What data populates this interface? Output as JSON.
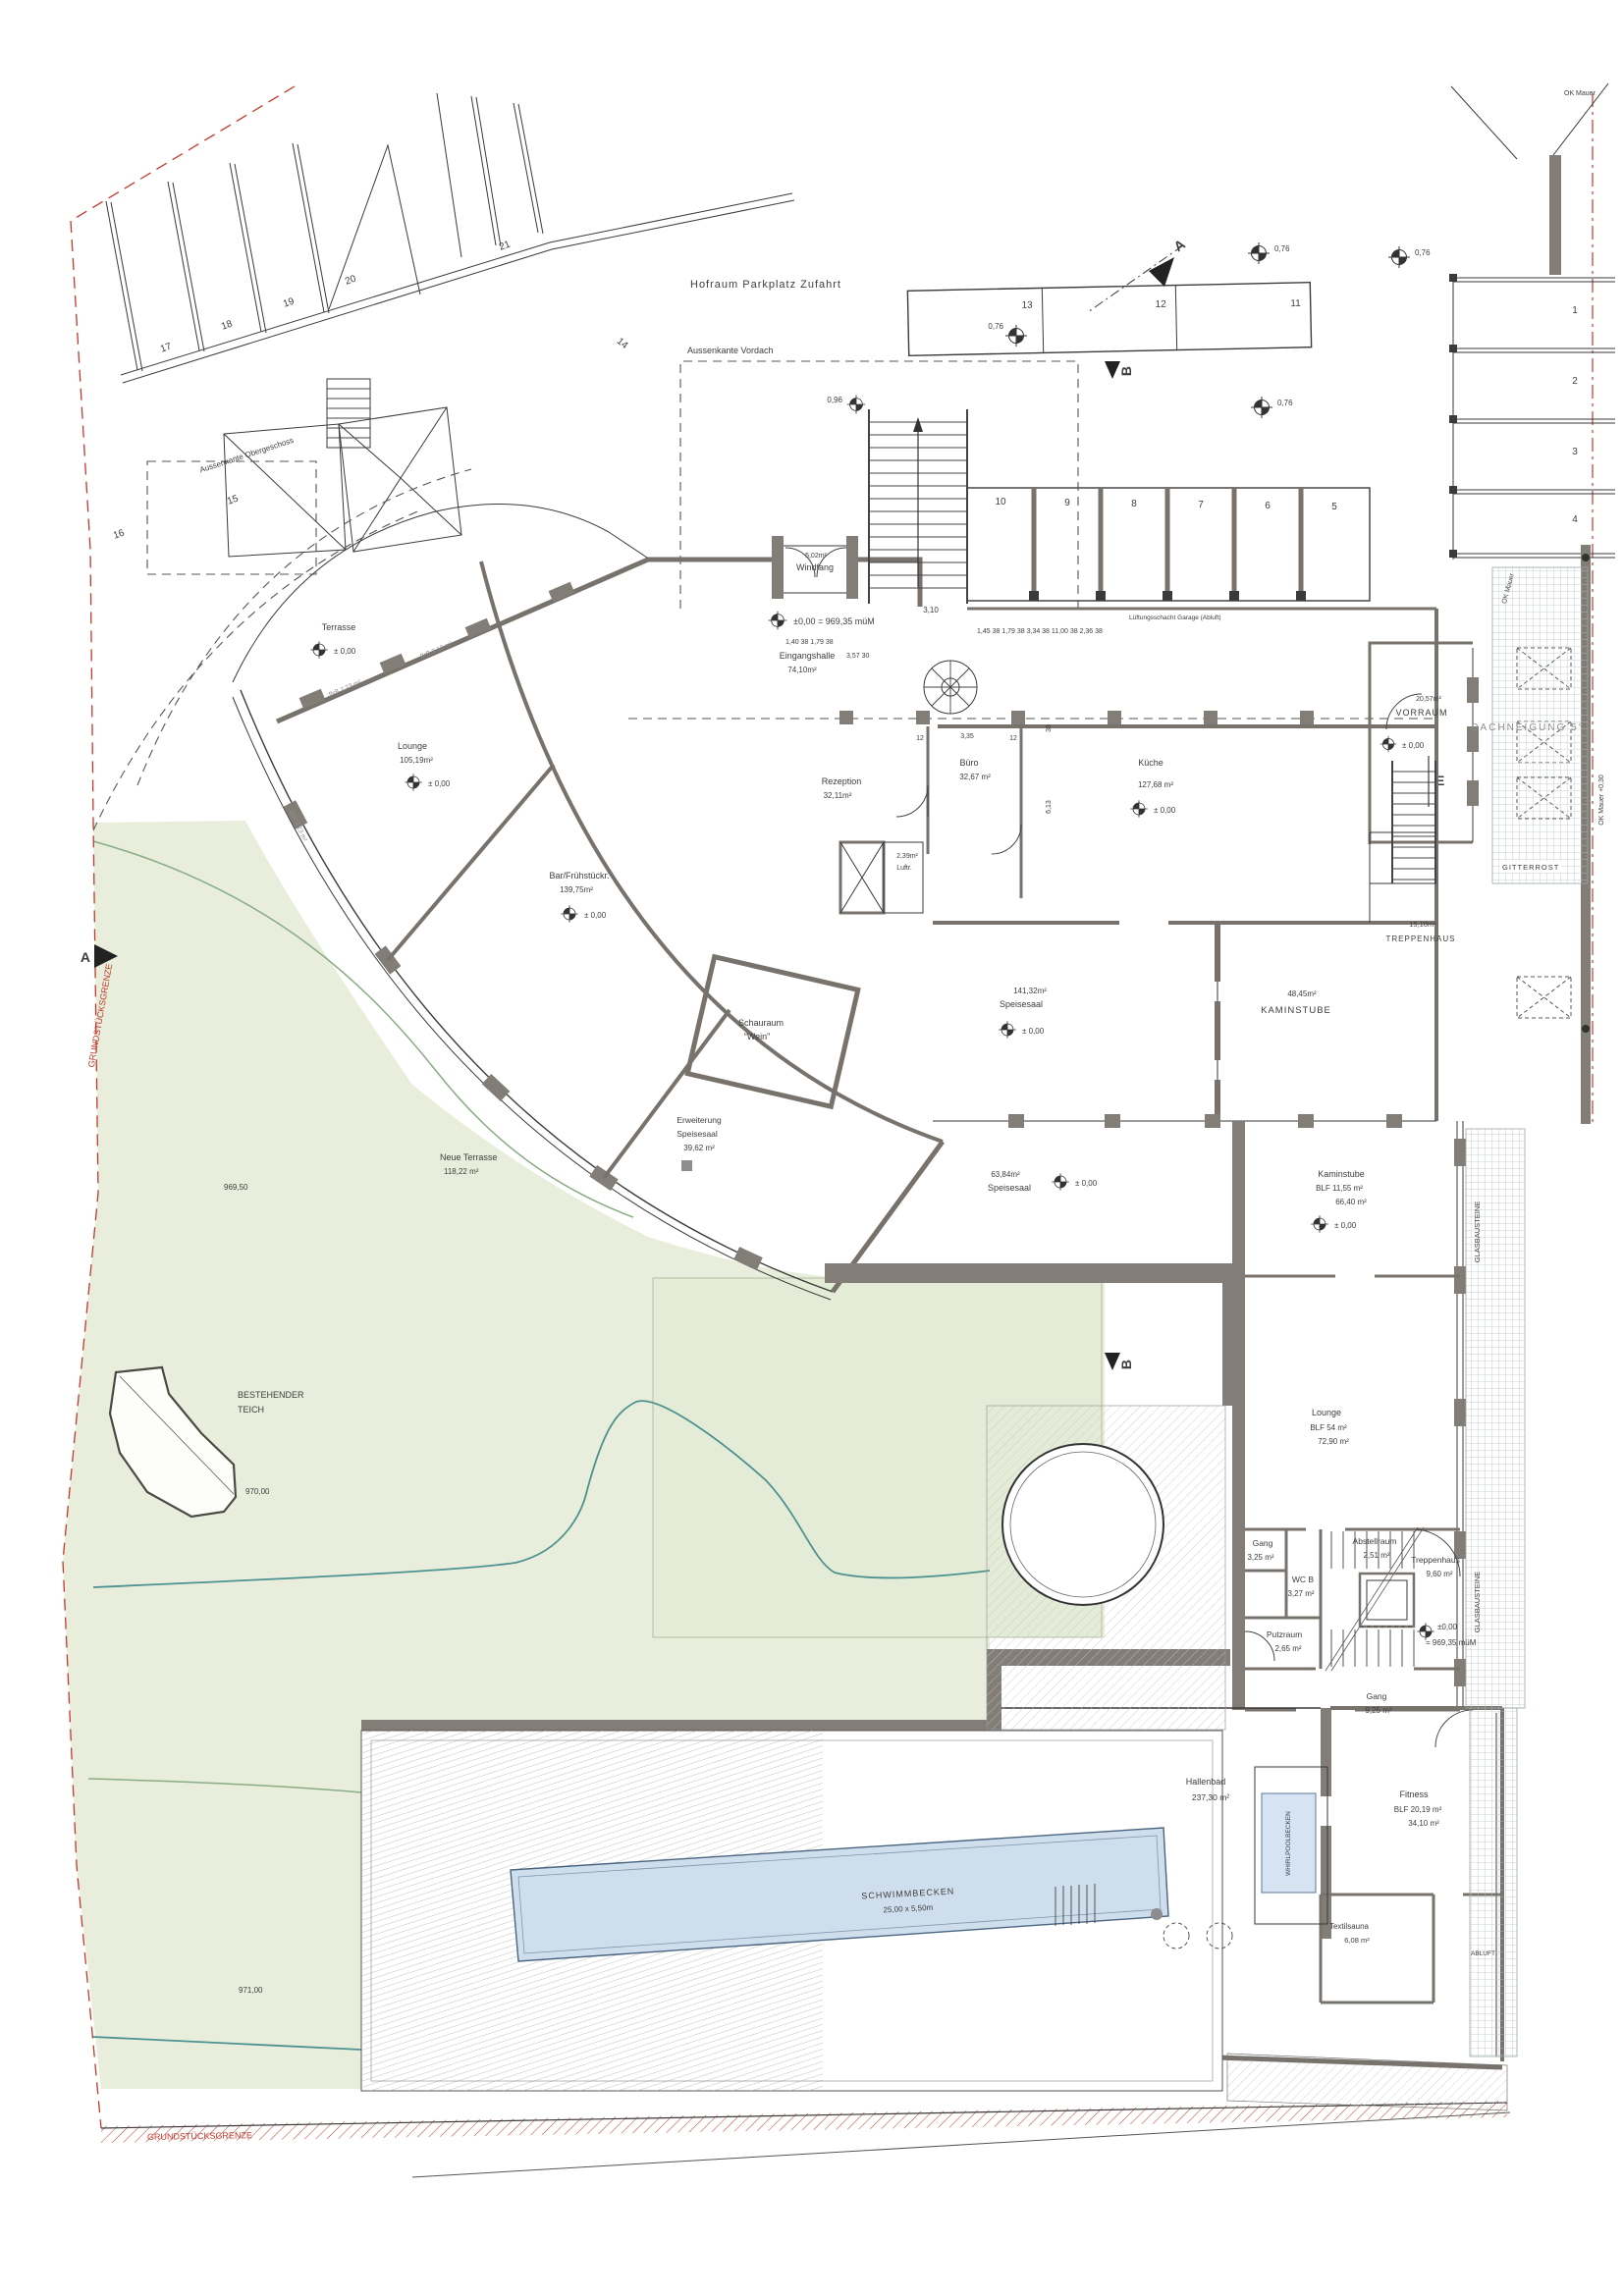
{
  "site": {
    "hofraum": "Hofraum  Parkplatz  Zufahrt",
    "aussenkante_vordach": "Aussenkante Vordach",
    "aussenkante_og": "Aussenkante Obergeschoss",
    "grenze_left": "GRUNDSTÜCKSGRENZE",
    "grenze_bottom": "GRUNDSTÜCKSGRENZE",
    "pond_1": "BESTEHENDER",
    "pond_2": "TEICH",
    "neue_terrasse_1": "Neue Terrasse",
    "neue_terrasse_2": "118,22 m²",
    "c96950": "969,50",
    "c97000": "970,00",
    "c97100": "971,00",
    "ok_mauer_top": "OK Mauer",
    "ok_mauer_mid": "OK Mauer",
    "ok_mauer_low": "OK Mauer +0,30",
    "gitterrost": "GITTERROST",
    "glasbausteine": "GLASBAUSTEINE"
  },
  "markers": {
    "section_a": "A",
    "section_b": "B",
    "detail_e": "E",
    "datum_entrance": "±0,00 = 969,35 müM",
    "datum_stair_1": "±0,00",
    "datum_stair_2": "= 969,35 müM",
    "level_zero": "± 0,00",
    "survey_076": "0,76",
    "survey_096": "0,96",
    "dim_310": "3,10"
  },
  "parking": {
    "numbers": [
      "17",
      "18",
      "19",
      "20",
      "21",
      "14",
      "15",
      "16",
      "13",
      "12",
      "11",
      "10",
      "9",
      "8",
      "7",
      "6",
      "5",
      "1",
      "2",
      "3",
      "4"
    ]
  },
  "rooms": {
    "terrasse": {
      "name": "Terrasse"
    },
    "lounge_w": {
      "name": "Lounge",
      "area": "105,19m²"
    },
    "bar": {
      "name": "Bar/Frühstückr.",
      "area": "139,75m²"
    },
    "windfang": {
      "area": "5,02m²",
      "name": "Windfang"
    },
    "halle": {
      "name": "Eingangshalle",
      "area": "74,10m²"
    },
    "rezeption": {
      "name": "Rezeption",
      "area": "32,11m²"
    },
    "buero": {
      "name": "Büro",
      "area": "32,67 m²"
    },
    "kueche": {
      "name": "Küche",
      "area": "127,68 m²"
    },
    "vorraum": {
      "area": "20,57m²",
      "name": "VORRAUM"
    },
    "dachneigung": {
      "name": "DACHNEIGUNG 5°"
    },
    "treppenhaus_or": {
      "area": "15,10m²",
      "name": "TREPPENHAUS"
    },
    "schauraum": {
      "name": "Schauraum",
      "sub": "\"Wein\""
    },
    "speisesaal": {
      "area": "141,32m²",
      "name": "Speisesaal"
    },
    "kaminstube_o": {
      "area": "48,45m²",
      "name": "KAMINSTUBE"
    },
    "erweiterung": {
      "l1": "Erweiterung",
      "l2": "Speisesaal",
      "l3": "39,62 m²"
    },
    "speisesaal63": {
      "area": "63,84m²",
      "name": "Speisesaal"
    },
    "kaminstube_u": {
      "name": "Kaminstube",
      "blf": "BLF 11,55 m²",
      "area": "66,40 m²"
    },
    "lounge_e": {
      "name": "Lounge",
      "blf": "BLF 54 m²",
      "area": "72,90 m²"
    },
    "gang1": {
      "name": "Gang",
      "area": "3,25 m²"
    },
    "abstellraum": {
      "name": "Abstellraum",
      "area": "2,51 m²"
    },
    "wcb": {
      "name": "WC B",
      "area": "3,27 m²"
    },
    "putzraum": {
      "name": "Putzraum",
      "area": "2,65 m²"
    },
    "treppenhaus_u": {
      "name": "Treppenhaus",
      "area": "9,60 m²"
    },
    "gang2": {
      "name": "Gang",
      "area": "9,25 m²"
    },
    "hallenbad": {
      "name": "Hallenbad",
      "area": "237,30 m²"
    },
    "whirlpool": {
      "name": "WHIRLPOOLBECKEN"
    },
    "fitness": {
      "name": "Fitness",
      "blf": "BLF 20,19 m²",
      "area": "34,10 m²"
    },
    "textilsauna": {
      "name": "Textilsauna",
      "area": "6,08 m²"
    },
    "abluft": {
      "name": "ABLUFT"
    },
    "schwimmbecken": {
      "name": "SCHWIMMBECKEN",
      "dim": "25,00 x 5,50m"
    },
    "luft": {
      "area": "2,39m²",
      "name": "Luftr."
    }
  },
  "dims": {
    "entry1": "1,40   38      1,79     38",
    "entry2": "3,57              30",
    "garage_chain": "1,45  38   1,79  38   3,34  38         11,00          38   2,36  38",
    "luftung": "Lüftungsschacht Garage (Abluft)",
    "d12a": "12",
    "d335": "3,35",
    "d12b": "12",
    "d613": "6,13",
    "d38": "38"
  },
  "windows": {
    "w1": "BrB 3,13 m²",
    "w2": "BrB 2,23 m²"
  }
}
